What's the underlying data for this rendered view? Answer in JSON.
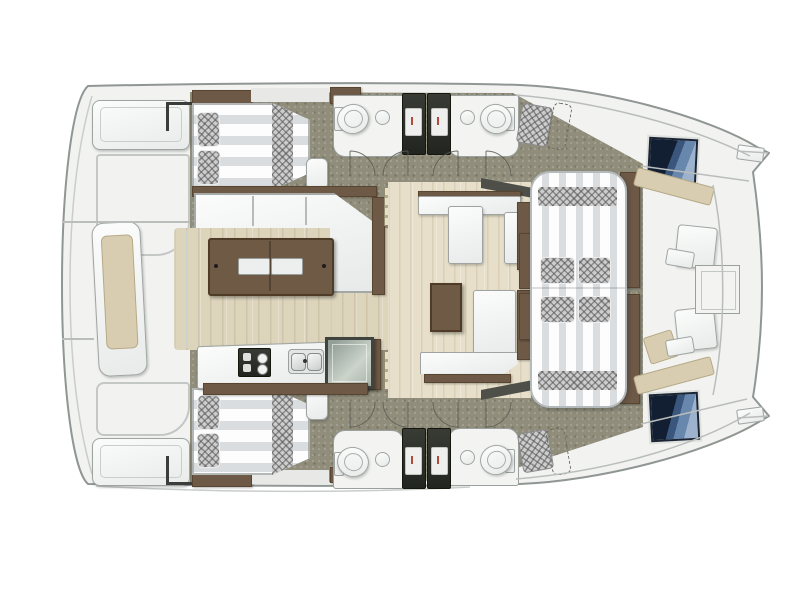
{
  "page": {
    "title": "Catamaran yacht interior layout — overhead floor plan (bow to the right)",
    "background": "#ffffff"
  },
  "palette": {
    "hull_fill": "#f2f3f1",
    "hull_stroke": "#8f9694",
    "deck_olive": "#908d7b",
    "wood_floor": "#ddd4bc",
    "lounge_floor": "#e7dfc9",
    "furniture_outline": "#9fa4a2",
    "brown_dark": "#6e5947",
    "brown_edge": "#57452f",
    "table_brown": "#6f5a45",
    "beige_cushion": "#d8cdb0",
    "beige_edge": "#b5a987",
    "steps_light": "#e6dec5",
    "steps_dark": "#b5aa8a",
    "mattress_white": "#fdfdfd",
    "mattress_gray": "#d9dde0",
    "checker_base": "#cdcdcd",
    "shower_dark": "#2e322c",
    "shower_tray": "#eff0ee",
    "hatch_navy": "#121e32",
    "hatch_mid": "#3a567c",
    "hatch_blue": "#6787ac",
    "hatch_light": "#9db3cd",
    "wedge_dark": "#4e4f49",
    "seam_gray": "#b9bdbb",
    "accent_red": "#b04a3c",
    "appliance_glass": "#9aa89b"
  },
  "vessel": {
    "kind": "catamaran-floor-plan",
    "orientation": "bow-right",
    "areas": [
      "aft-platform",
      "port-aft-cabin",
      "starboard-aft-cabin",
      "port-head",
      "starboard-head",
      "port-shower",
      "starboard-shower",
      "saloon",
      "galley",
      "port-companionway-steps",
      "starboard-companionway-steps",
      "midship-lounge",
      "sunpad-lounge",
      "forward-cockpit",
      "port-bow",
      "starboard-bow"
    ],
    "fixture_counts": {
      "double-berths": 2,
      "berth-pillows": 4,
      "toilets": 4,
      "bathroom-sinks": 4,
      "shower-stalls": 4,
      "deck-hatches": 2,
      "companionway-steps": 2,
      "dining-tables": 2,
      "sunpad-cushions": 4,
      "helm-seat-pads": 2
    }
  }
}
